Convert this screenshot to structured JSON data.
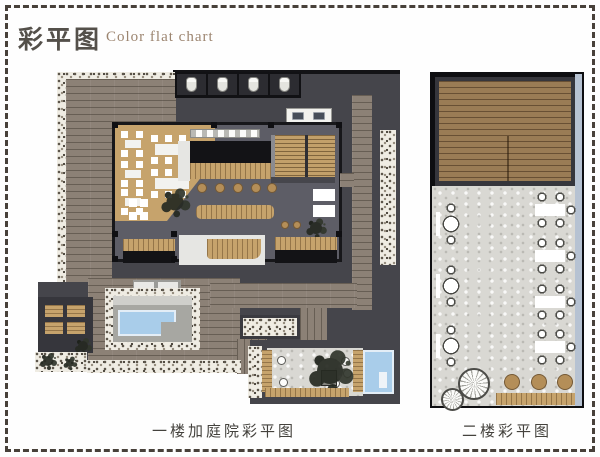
{
  "header": {
    "title": "彩平图",
    "subtitle": "Color flat chart"
  },
  "plans": {
    "first_floor": {
      "caption": "一楼加庭院彩平图"
    },
    "second_floor": {
      "caption": "二楼彩平图"
    }
  },
  "palette": {
    "border_dash": "#48413a",
    "title_cn": "#54504a",
    "title_en": "#9c8570",
    "caption_text": "#44423d",
    "dark_mass": "#45454b",
    "hall_floor": "#5d5d66",
    "deck_gray": "#8c8176",
    "deck_brown": "#9a7c55",
    "wood_tan": "#c6a36c",
    "pool_blue": "#a9cdea",
    "gravel": "#d9d8d3",
    "pebble": "#efece3",
    "glass_strip": "#b6c2d2"
  }
}
